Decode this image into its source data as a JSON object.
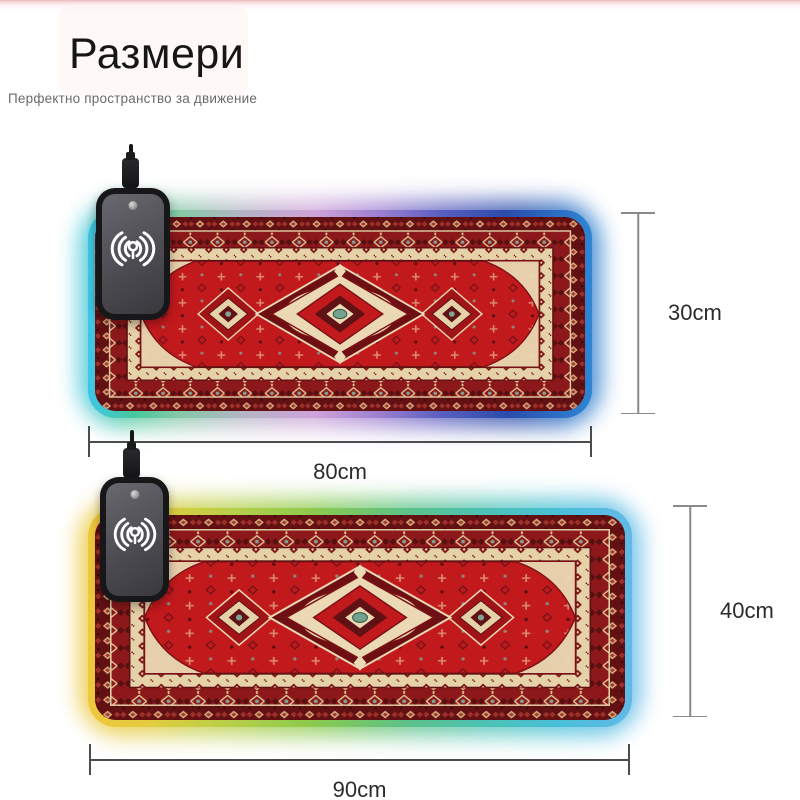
{
  "header": {
    "title": "Размери",
    "subtitle": "Перфектно пространство за движение"
  },
  "pads": [
    {
      "width_label": "80cm",
      "height_label": "30cm"
    },
    {
      "width_label": "90cm",
      "height_label": "40cm"
    }
  ],
  "icons": {
    "charger_icon": "qi-wireless-charging-icon",
    "charger_logo": "brand-logo-dot"
  },
  "colors": {
    "carpet_field_red": "#c2191d",
    "carpet_cream": "#e6d2a8",
    "carpet_maroon": "#631013",
    "carpet_teal_accent": "#74a291",
    "pad1_rgb_rim": [
      "#3fc6e8",
      "#46c89e",
      "#cfa3da",
      "#9b7fd0",
      "#2b4bab",
      "#2e86d4"
    ],
    "pad2_rgb_rim": [
      "#eec73b",
      "#8aca4e",
      "#4cc2b2",
      "#62b9e8"
    ],
    "dimension_line": "#4c4c4c",
    "top_tint_pink": "#f3cdcd"
  }
}
